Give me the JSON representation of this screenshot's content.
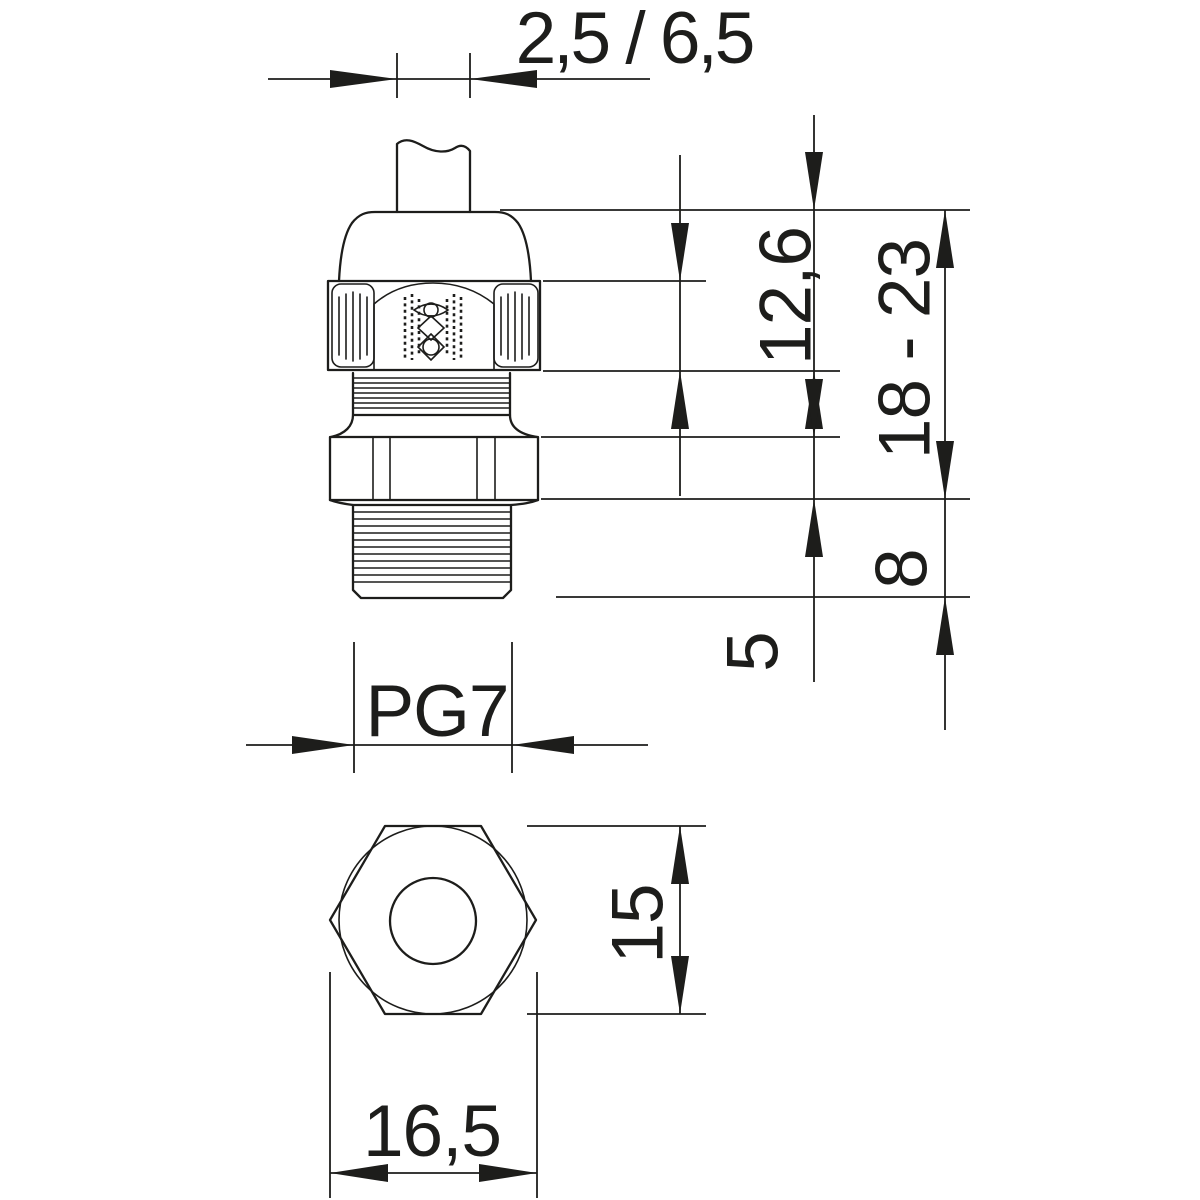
{
  "labels": {
    "clamping_range": "2,5 / 6,5",
    "cap_hex_height": "12,6",
    "total_height_range": "18 - 23",
    "thread_length": "8",
    "flange_height": "5",
    "thread_size": "PG7",
    "across_flats": "15",
    "across_corners": "16,5"
  },
  "colors": {
    "ink": "#1d1d1b",
    "background": "#ffffff"
  }
}
